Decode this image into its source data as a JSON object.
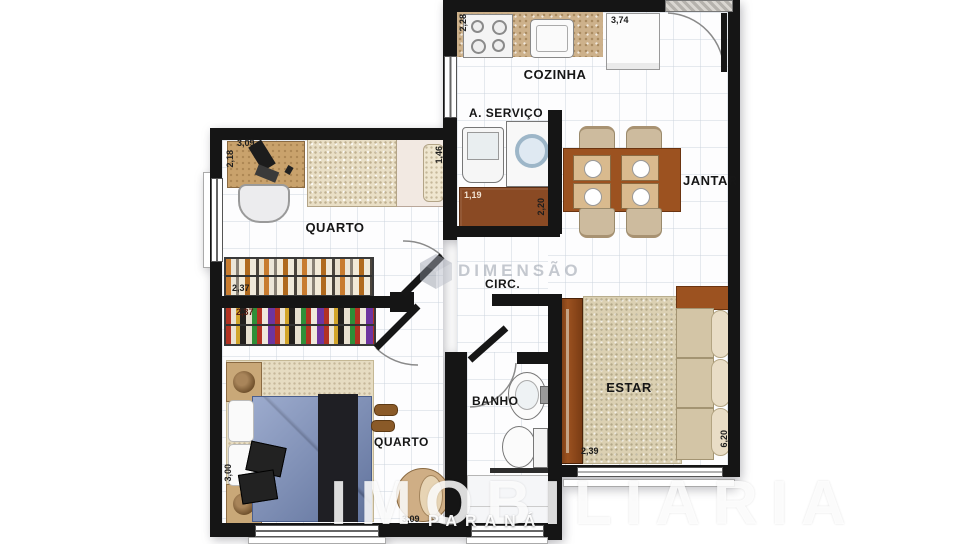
{
  "rooms": {
    "cozinha": "COZINHA",
    "servico": "A. SERVIÇO",
    "jantar": "JANTAR",
    "quarto1": "QUARTO",
    "circ": "CIRC.",
    "quarto2": "QUARTO",
    "banho": "BANHO",
    "estar": "ESTAR"
  },
  "dimensions": {
    "kitchen_depth": "2,28",
    "fridge_width": "3,74",
    "desk_width": "3,09",
    "desk_depth": "2,18",
    "bed1_width": "1,46",
    "wardrobe1_width": "2,37",
    "wardrobe2_width": "2,37",
    "service_bench_width": "1,19",
    "service_bench_depth": "2,20",
    "quarto2_depth": "3,00",
    "quarto2_width": "3,09",
    "estar_width": "2,39",
    "estar_depth": "6,20"
  },
  "watermark": {
    "center": "DIMENSÃO",
    "brand": "IMOBILIARIA",
    "region": "PARANÁ"
  },
  "colors": {
    "wall": "#151515",
    "counter": "#cdb18b",
    "table_wood": "#9c5220",
    "bench_wood": "#8a4a24",
    "bed_blue": "#7287b8",
    "sofa": "#d3c5a6",
    "rug": "#dbd0b2"
  }
}
